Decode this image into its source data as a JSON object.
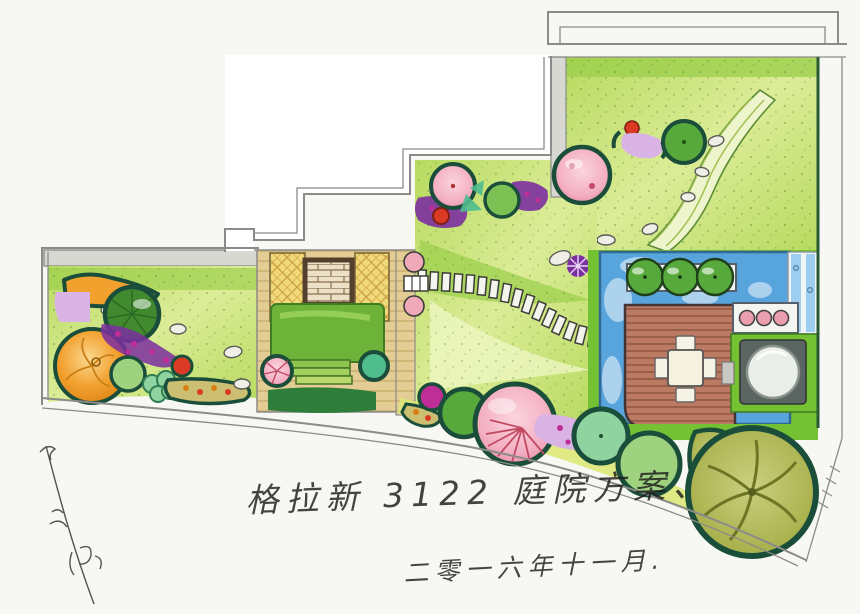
{
  "annotations": {
    "title": "格拉新 3122 庭院方案、",
    "date": "二零一六年十一月."
  },
  "palette": {
    "paper": "#f7f7f3",
    "line": "#8b8b89",
    "outline": "#1b4e3a",
    "lawnLight": "#dcec97",
    "lawnMid": "#b7da5f",
    "lawnDark": "#86c23f",
    "wash": "#9ed04e",
    "tan": "#e4cd94",
    "tanLine": "#c7a96a",
    "lattice": "#f1d878",
    "latticeLine": "#c79d3e",
    "brick": "#ece1c6",
    "brickLine": "#8a6f4d",
    "brickBorder": "#54402c",
    "gray": "#d8d8d3",
    "pool": "#58a5dd",
    "poolLight": "#9dcdef",
    "poolDeep": "#33688f",
    "deck": "#bd7a62",
    "deckLine": "#8c5340",
    "spa": "#5b6562",
    "spaDial": "#e9efe8",
    "brightGreen": "#74c234",
    "treeGreen": "#57a93c",
    "treeLight": "#9ed27f",
    "treeMint": "#8fd3a0",
    "teal": "#4fbd8e",
    "olive": "#a9b14d",
    "oliveDark": "#6d7524",
    "orange": "#f2a02e",
    "orangeDeep": "#d97f12",
    "pink": "#f3aec2",
    "pinkDeep": "#e2738f",
    "magenta": "#bf2e96",
    "purple": "#7b2fa0",
    "lilac": "#d9b3e4",
    "red": "#da3a24",
    "rock": "#efefe8"
  }
}
